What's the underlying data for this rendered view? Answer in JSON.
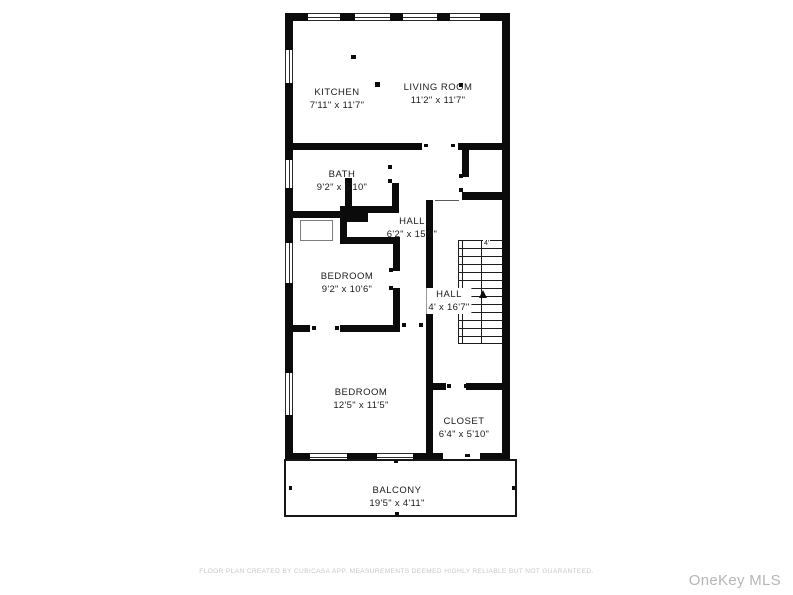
{
  "image_type": "floor-plan",
  "colors": {
    "background": "#ffffff",
    "walls": "#0b0b0b",
    "room_text": "#1b1b1b",
    "disclaimer_text": "#c7c7c7",
    "watermark_text": "#b6b6b6"
  },
  "floor_plan": {
    "rooms": [
      {
        "id": "kitchen",
        "name": "KITCHEN",
        "dimensions": "7'11\" x 11'7\""
      },
      {
        "id": "living_room",
        "name": "LIVING ROOM",
        "dimensions": "11'2\" x 11'7\""
      },
      {
        "id": "bath",
        "name": "BATH",
        "dimensions": "9'2\" x 5'10\""
      },
      {
        "id": "hall_upper",
        "name": "HALL",
        "dimensions": "6'2\" x 15'9\""
      },
      {
        "id": "bedroom_1",
        "name": "BEDROOM",
        "dimensions": "9'2\" x 10'6\""
      },
      {
        "id": "hall_stairs",
        "name": "HALL",
        "dimensions": "4' x 16'7\""
      },
      {
        "id": "bedroom_2",
        "name": "BEDROOM",
        "dimensions": "12'5\" x 11'5\""
      },
      {
        "id": "closet",
        "name": "CLOSET",
        "dimensions": "6'4\" x 5'10\""
      },
      {
        "id": "balcony",
        "name": "BALCONY",
        "dimensions": "19'5\" x 4'11\""
      }
    ],
    "stairs": {
      "width_label": "4'"
    }
  },
  "footer": {
    "disclaimer": "FLOOR PLAN CREATED BY CUBICASA APP. MEASUREMENTS DEEMED HIGHLY RELIABLE BUT NOT GUARANTEED."
  },
  "watermark": {
    "text": "OneKey MLS"
  }
}
